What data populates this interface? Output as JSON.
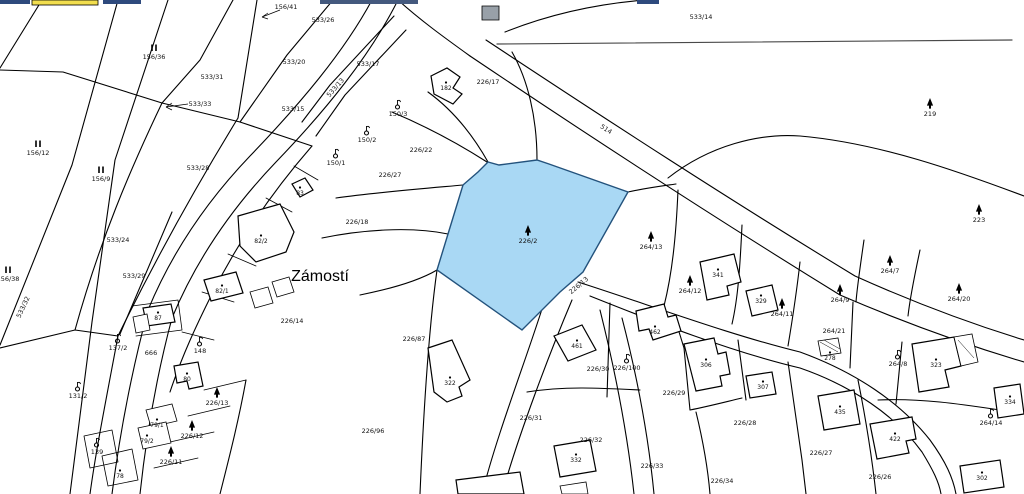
{
  "map": {
    "place_label": "Zámostí",
    "background_color": "#ffffff",
    "boundary_color": "#000000",
    "highlight": {
      "parcel_number": "226/2",
      "fill": "#a9d8f4",
      "stroke": "#23527c",
      "land_use": "forest"
    },
    "edge_strips": [
      {
        "x": 0,
        "y": 0,
        "w": 30,
        "h": 4,
        "fill": "#2e4a7d",
        "stroke": "none"
      },
      {
        "x": 32,
        "y": 0,
        "w": 66,
        "h": 5,
        "fill": "#f2de4e",
        "stroke": "#000000"
      },
      {
        "x": 103,
        "y": 0,
        "w": 38,
        "h": 4,
        "fill": "#2e4a7d",
        "stroke": "none"
      },
      {
        "x": 320,
        "y": 0,
        "w": 98,
        "h": 4,
        "fill": "#44597e",
        "stroke": "none"
      },
      {
        "x": 637,
        "y": 0,
        "w": 22,
        "h": 4,
        "fill": "#2e4a7d",
        "stroke": "none"
      }
    ],
    "legend_note": "type: parcel=plain number, forest=conifer symbol, orchard=fruit-tree symbol, meadow=II symbol, building=dot marker, road=rotated road label, place=settlement name",
    "labels": [
      {
        "t": "156/41",
        "x": 286,
        "y": 9,
        "type": "parcel"
      },
      {
        "t": "533/26",
        "x": 323,
        "y": 22,
        "type": "parcel"
      },
      {
        "t": "156/36",
        "x": 154,
        "y": 59,
        "type": "meadow"
      },
      {
        "t": "533/20",
        "x": 294,
        "y": 64,
        "type": "parcel"
      },
      {
        "t": "533/31",
        "x": 212,
        "y": 79,
        "type": "parcel"
      },
      {
        "t": "533/33",
        "x": 200,
        "y": 106,
        "type": "parcel"
      },
      {
        "t": "533/15",
        "x": 293,
        "y": 111,
        "type": "parcel"
      },
      {
        "t": "533/14",
        "x": 701,
        "y": 19,
        "type": "parcel"
      },
      {
        "t": "156/12",
        "x": 38,
        "y": 155,
        "type": "meadow"
      },
      {
        "t": "533/17",
        "x": 368,
        "y": 66,
        "type": "parcel"
      },
      {
        "t": "533/13",
        "x": 337,
        "y": 89,
        "type": "road",
        "rot": -49
      },
      {
        "t": "156/9",
        "x": 101,
        "y": 181,
        "type": "meadow"
      },
      {
        "t": "533/28",
        "x": 198,
        "y": 170,
        "type": "parcel"
      },
      {
        "t": "533/24",
        "x": 118,
        "y": 242,
        "type": "parcel"
      },
      {
        "t": "533/29",
        "x": 134,
        "y": 278,
        "type": "parcel"
      },
      {
        "t": "533/32",
        "x": 25,
        "y": 308,
        "type": "road",
        "rot": -65
      },
      {
        "t": "156/38",
        "x": 8,
        "y": 281,
        "type": "meadow"
      },
      {
        "t": "226/17",
        "x": 488,
        "y": 84,
        "type": "parcel"
      },
      {
        "t": "182",
        "x": 446,
        "y": 90,
        "type": "building"
      },
      {
        "t": "150/3",
        "x": 398,
        "y": 116,
        "type": "orchard"
      },
      {
        "t": "150/2",
        "x": 367,
        "y": 142,
        "type": "orchard"
      },
      {
        "t": "150/1",
        "x": 336,
        "y": 165,
        "type": "orchard"
      },
      {
        "t": "226/22",
        "x": 421,
        "y": 152,
        "type": "parcel"
      },
      {
        "t": "226/27",
        "x": 390,
        "y": 177,
        "type": "parcel"
      },
      {
        "t": "514",
        "x": 605,
        "y": 131,
        "type": "road",
        "rot": 33
      },
      {
        "t": "219",
        "x": 930,
        "y": 116,
        "type": "forest"
      },
      {
        "t": "223",
        "x": 979,
        "y": 222,
        "type": "forest"
      },
      {
        "t": "226/2",
        "x": 528,
        "y": 243,
        "type": "forest",
        "color": "#1c3d5c"
      },
      {
        "t": "264/13",
        "x": 651,
        "y": 249,
        "type": "forest"
      },
      {
        "t": "Zámostí",
        "x": 320,
        "y": 281,
        "type": "place"
      },
      {
        "t": "82/2",
        "x": 261,
        "y": 243,
        "type": "building"
      },
      {
        "t": "83",
        "x": 300,
        "y": 195,
        "type": "building"
      },
      {
        "t": "82/1",
        "x": 222,
        "y": 293,
        "type": "building"
      },
      {
        "t": "226/18",
        "x": 357,
        "y": 224,
        "type": "parcel"
      },
      {
        "t": "226/14",
        "x": 292,
        "y": 323,
        "type": "parcel"
      },
      {
        "t": "226/13",
        "x": 580,
        "y": 287,
        "type": "road",
        "rot": -40
      },
      {
        "t": "226/87",
        "x": 414,
        "y": 341,
        "type": "parcel"
      },
      {
        "t": "137/2",
        "x": 118,
        "y": 350,
        "type": "orchard"
      },
      {
        "t": "87",
        "x": 158,
        "y": 320,
        "type": "building"
      },
      {
        "t": "666",
        "x": 151,
        "y": 355,
        "type": "parcel"
      },
      {
        "t": "148",
        "x": 200,
        "y": 353,
        "type": "orchard"
      },
      {
        "t": "131/2",
        "x": 78,
        "y": 398,
        "type": "orchard"
      },
      {
        "t": "80",
        "x": 187,
        "y": 381,
        "type": "building"
      },
      {
        "t": "226/13",
        "x": 217,
        "y": 405,
        "type": "forest"
      },
      {
        "t": "226/12",
        "x": 192,
        "y": 438,
        "type": "forest"
      },
      {
        "t": "226/11",
        "x": 171,
        "y": 464,
        "type": "forest"
      },
      {
        "t": "79/1",
        "x": 157,
        "y": 427,
        "type": "building"
      },
      {
        "t": "79/2",
        "x": 147,
        "y": 443,
        "type": "building"
      },
      {
        "t": "78",
        "x": 120,
        "y": 478,
        "type": "building"
      },
      {
        "t": "139",
        "x": 97,
        "y": 454,
        "type": "orchard"
      },
      {
        "t": "226/96",
        "x": 373,
        "y": 433,
        "type": "parcel"
      },
      {
        "t": "322",
        "x": 450,
        "y": 385,
        "type": "building"
      },
      {
        "t": "461",
        "x": 577,
        "y": 348,
        "type": "building"
      },
      {
        "t": "226/30",
        "x": 598,
        "y": 371,
        "type": "parcel"
      },
      {
        "t": "226/100",
        "x": 627,
        "y": 370,
        "type": "orchard"
      },
      {
        "t": "462",
        "x": 655,
        "y": 334,
        "type": "building"
      },
      {
        "t": "226/29",
        "x": 674,
        "y": 395,
        "type": "parcel"
      },
      {
        "t": "306",
        "x": 706,
        "y": 367,
        "type": "building"
      },
      {
        "t": "226/31",
        "x": 531,
        "y": 420,
        "type": "parcel"
      },
      {
        "t": "226/32",
        "x": 591,
        "y": 442,
        "type": "parcel"
      },
      {
        "t": "332",
        "x": 576,
        "y": 462,
        "type": "building"
      },
      {
        "t": "226/33",
        "x": 652,
        "y": 468,
        "type": "parcel"
      },
      {
        "t": "226/34",
        "x": 722,
        "y": 483,
        "type": "parcel"
      },
      {
        "t": "226/28",
        "x": 745,
        "y": 425,
        "type": "parcel"
      },
      {
        "t": "307",
        "x": 763,
        "y": 389,
        "type": "building"
      },
      {
        "t": "435",
        "x": 840,
        "y": 414,
        "type": "building"
      },
      {
        "t": "422",
        "x": 895,
        "y": 441,
        "type": "building"
      },
      {
        "t": "226/26",
        "x": 880,
        "y": 479,
        "type": "parcel"
      },
      {
        "t": "226/27",
        "x": 821,
        "y": 455,
        "type": "parcel"
      },
      {
        "t": "264/21",
        "x": 834,
        "y": 333,
        "type": "parcel"
      },
      {
        "t": "278",
        "x": 830,
        "y": 360,
        "type": "building"
      },
      {
        "t": "264/8",
        "x": 898,
        "y": 366,
        "type": "orchard"
      },
      {
        "t": "323",
        "x": 936,
        "y": 367,
        "type": "building"
      },
      {
        "t": "264/14",
        "x": 991,
        "y": 425,
        "type": "orchard"
      },
      {
        "t": "334",
        "x": 1010,
        "y": 404,
        "type": "building"
      },
      {
        "t": "302",
        "x": 982,
        "y": 480,
        "type": "building"
      },
      {
        "t": "264/7",
        "x": 890,
        "y": 273,
        "type": "forest"
      },
      {
        "t": "264/20",
        "x": 959,
        "y": 301,
        "type": "forest"
      },
      {
        "t": "264/9",
        "x": 840,
        "y": 302,
        "type": "forest"
      },
      {
        "t": "264/11",
        "x": 782,
        "y": 316,
        "type": "forest"
      },
      {
        "t": "264/12",
        "x": 690,
        "y": 293,
        "type": "forest"
      },
      {
        "t": "341",
        "x": 718,
        "y": 277,
        "type": "building"
      },
      {
        "t": "329",
        "x": 761,
        "y": 303,
        "type": "building"
      }
    ]
  }
}
